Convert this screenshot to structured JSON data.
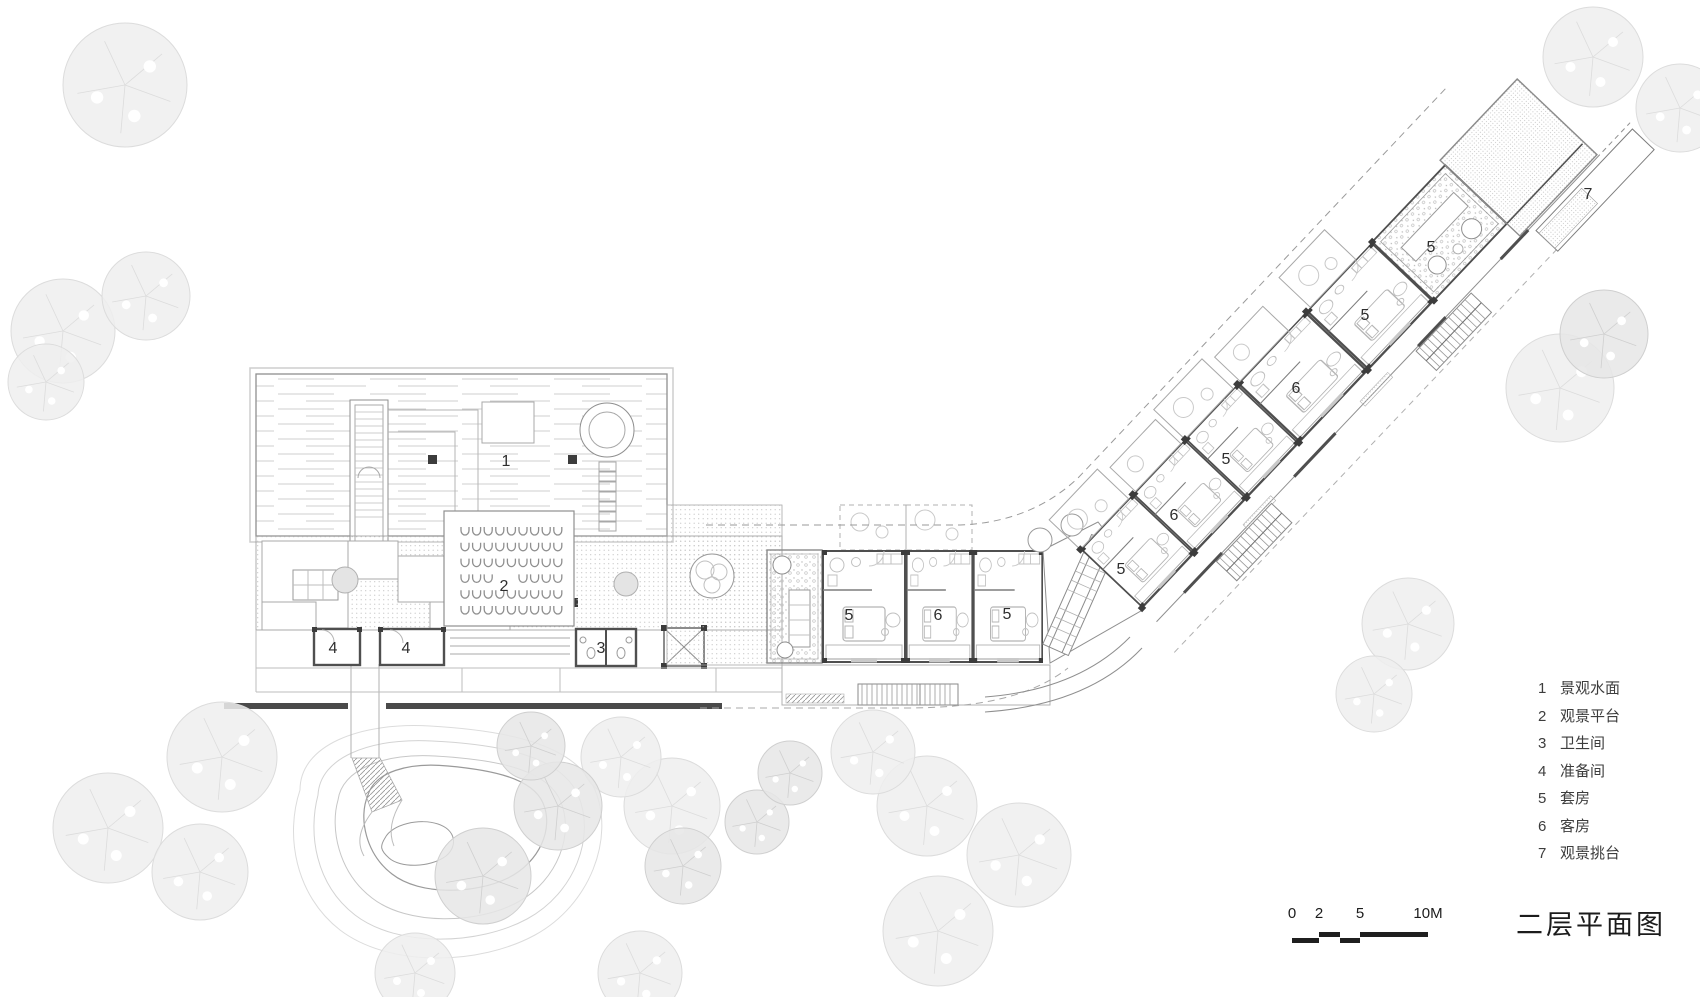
{
  "title": "二层平面图",
  "legend": {
    "items": [
      {
        "num": "1",
        "label": "景观水面"
      },
      {
        "num": "2",
        "label": "观景平台"
      },
      {
        "num": "3",
        "label": "卫生间"
      },
      {
        "num": "4",
        "label": "准备间"
      },
      {
        "num": "5",
        "label": "套房"
      },
      {
        "num": "6",
        "label": "客房"
      },
      {
        "num": "7",
        "label": "观景挑台"
      }
    ]
  },
  "scale_bar": {
    "labels": [
      "0",
      "2",
      "5",
      "10M"
    ],
    "label_x": [
      10,
      37,
      78,
      146
    ]
  },
  "plan_labels": [
    {
      "text": "1",
      "x": 506,
      "y": 466
    },
    {
      "text": "2",
      "x": 504,
      "y": 591
    },
    {
      "text": "4",
      "x": 333,
      "y": 653
    },
    {
      "text": "4",
      "x": 406,
      "y": 653
    },
    {
      "text": "3",
      "x": 601,
      "y": 653
    },
    {
      "text": "5",
      "x": 849,
      "y": 620
    },
    {
      "text": "6",
      "x": 938,
      "y": 620
    },
    {
      "text": "5",
      "x": 1007,
      "y": 619
    },
    {
      "text": "5",
      "x": 1121,
      "y": 574
    },
    {
      "text": "6",
      "x": 1174,
      "y": 520
    },
    {
      "text": "5",
      "x": 1226,
      "y": 464
    },
    {
      "text": "6",
      "x": 1296,
      "y": 393
    },
    {
      "text": "5",
      "x": 1365,
      "y": 320
    },
    {
      "text": "5",
      "x": 1431,
      "y": 252
    },
    {
      "text": "7",
      "x": 1588,
      "y": 199
    }
  ],
  "platform_seats": {
    "rows": 6,
    "cols": 9,
    "skip": [
      [
        3,
        3
      ],
      [
        3,
        4
      ]
    ]
  },
  "trees": [
    {
      "x": 125,
      "y": 85,
      "r": 62,
      "s": 0
    },
    {
      "x": 63,
      "y": 331,
      "r": 52,
      "s": 0
    },
    {
      "x": 146,
      "y": 296,
      "r": 44,
      "s": 0
    },
    {
      "x": 46,
      "y": 382,
      "r": 38,
      "s": 0
    },
    {
      "x": 1593,
      "y": 57,
      "r": 50,
      "s": 0
    },
    {
      "x": 1680,
      "y": 108,
      "r": 44,
      "s": 0
    },
    {
      "x": 1560,
      "y": 388,
      "r": 54,
      "s": 0
    },
    {
      "x": 1604,
      "y": 334,
      "r": 44,
      "s": 1
    },
    {
      "x": 1408,
      "y": 624,
      "r": 46,
      "s": 0
    },
    {
      "x": 1374,
      "y": 694,
      "r": 38,
      "s": 0
    },
    {
      "x": 222,
      "y": 757,
      "r": 55,
      "s": 0
    },
    {
      "x": 108,
      "y": 828,
      "r": 55,
      "s": 0
    },
    {
      "x": 200,
      "y": 872,
      "r": 48,
      "s": 0
    },
    {
      "x": 672,
      "y": 806,
      "r": 48,
      "s": 0
    },
    {
      "x": 621,
      "y": 757,
      "r": 40,
      "s": 0
    },
    {
      "x": 927,
      "y": 806,
      "r": 50,
      "s": 0
    },
    {
      "x": 873,
      "y": 752,
      "r": 42,
      "s": 0
    },
    {
      "x": 1019,
      "y": 855,
      "r": 52,
      "s": 0
    },
    {
      "x": 938,
      "y": 931,
      "r": 55,
      "s": 0
    },
    {
      "x": 640,
      "y": 973,
      "r": 42,
      "s": 0
    },
    {
      "x": 415,
      "y": 973,
      "r": 40,
      "s": 0
    },
    {
      "x": 558,
      "y": 806,
      "r": 44,
      "s": 1
    },
    {
      "x": 483,
      "y": 876,
      "r": 48,
      "s": 1
    },
    {
      "x": 683,
      "y": 866,
      "r": 38,
      "s": 1
    },
    {
      "x": 757,
      "y": 822,
      "r": 32,
      "s": 1
    },
    {
      "x": 531,
      "y": 746,
      "r": 34,
      "s": 1
    },
    {
      "x": 790,
      "y": 773,
      "r": 32,
      "s": 1
    }
  ],
  "colors": {
    "wall_dark": "#4f4f4f",
    "line_med": "#8f8f8f",
    "line_light": "#bdbdbd",
    "line_faint": "#d9d9d9",
    "bar_dark": "#1f1f1f",
    "column": "#3c3c3c"
  }
}
